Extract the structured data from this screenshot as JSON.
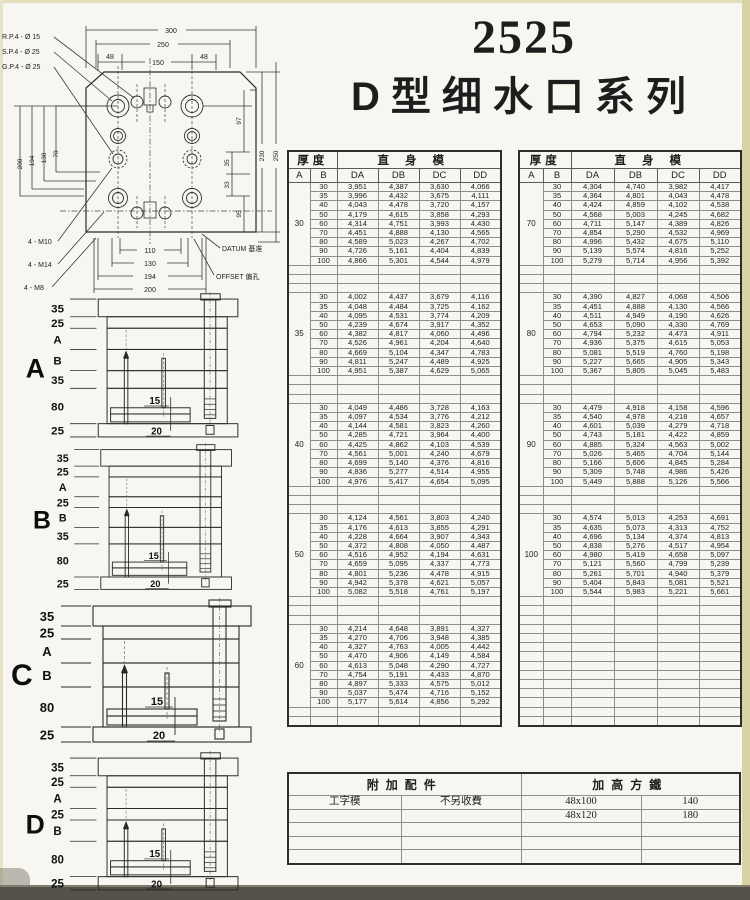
{
  "title": {
    "number": "2525",
    "series": "D型细水口系列"
  },
  "drawing": {
    "hole_labels": [
      "R.P.4 - Ø 15",
      "S.P.4 - Ø 25",
      "G.P.4 - Ø 25"
    ],
    "thread_labels": [
      "4 - M10",
      "4 - M14",
      "4 - M8"
    ],
    "datum_label": "DATUM 基准",
    "offset_label": "OFFSET 偏孔",
    "dim_300": "300",
    "dim_250": "250",
    "dim_48a": "48",
    "dim_150": "150",
    "dim_48b": "48",
    "left_dims": [
      "200",
      "194",
      "130",
      "70"
    ],
    "right_dims": [
      "97",
      "35",
      "33",
      "95",
      "230",
      "250"
    ],
    "bottom_dims": [
      "110",
      "130",
      "194",
      "200"
    ]
  },
  "diagrams": [
    {
      "label": "A",
      "stack": [
        "35",
        "25",
        "A",
        "B",
        "35",
        "80",
        "25"
      ],
      "inner_top": "15",
      "inner_bottom": "20"
    },
    {
      "label": "B",
      "stack": [
        "35",
        "25",
        "A",
        "25",
        "B",
        "35",
        "80",
        "25"
      ],
      "inner_top": "15",
      "inner_bottom": "20"
    },
    {
      "label": "C",
      "stack": [
        "35",
        "25",
        "A",
        "B",
        "80",
        "25"
      ],
      "inner_top": "15",
      "inner_bottom": "20"
    },
    {
      "label": "D",
      "stack": [
        "35",
        "25",
        "A",
        "25",
        "B",
        "80",
        "25"
      ],
      "inner_top": "15",
      "inner_bottom": "20"
    }
  ],
  "size_table": {
    "headers": {
      "thickness": "厚度",
      "mold": "直身模",
      "col_a": "A",
      "col_b": "B",
      "col_da": "DA",
      "col_db": "DB",
      "col_dc": "DC",
      "col_dd": "DD"
    },
    "left_blocks": [
      {
        "a": "30",
        "rows": [
          [
            "30",
            "3,951",
            "4,387",
            "3,630",
            "4,066"
          ],
          [
            "35",
            "3,996",
            "4,432",
            "3,675",
            "4,111"
          ],
          [
            "40",
            "4,043",
            "4,478",
            "3,720",
            "4,157"
          ],
          [
            "50",
            "4,179",
            "4,615",
            "3,858",
            "4,293"
          ],
          [
            "60",
            "4,314",
            "4,751",
            "3,993",
            "4,430"
          ],
          [
            "70",
            "4,451",
            "4,888",
            "4,130",
            "4,565"
          ],
          [
            "80",
            "4,589",
            "5,023",
            "4,267",
            "4,702"
          ],
          [
            "90",
            "4,726",
            "5,161",
            "4,404",
            "4,839"
          ],
          [
            "100",
            "4,866",
            "5,301",
            "4,544",
            "4,979"
          ]
        ]
      },
      {
        "a": "35",
        "rows": [
          [
            "30",
            "4,002",
            "4,437",
            "3,679",
            "4,116"
          ],
          [
            "35",
            "4,048",
            "4,484",
            "3,725",
            "4,162"
          ],
          [
            "40",
            "4,095",
            "4,531",
            "3,774",
            "4,209"
          ],
          [
            "50",
            "4,239",
            "4,674",
            "3,917",
            "4,352"
          ],
          [
            "60",
            "4,382",
            "4,817",
            "4,060",
            "4,496"
          ],
          [
            "70",
            "4,526",
            "4,961",
            "4,204",
            "4,640"
          ],
          [
            "80",
            "4,669",
            "5,104",
            "4,347",
            "4,783"
          ],
          [
            "90",
            "4,811",
            "5,247",
            "4,489",
            "4,925"
          ],
          [
            "100",
            "4,951",
            "5,387",
            "4,629",
            "5,065"
          ]
        ]
      },
      {
        "a": "40",
        "rows": [
          [
            "30",
            "4,049",
            "4,486",
            "3,728",
            "4,163"
          ],
          [
            "35",
            "4,097",
            "4,534",
            "3,776",
            "4,212"
          ],
          [
            "40",
            "4,144",
            "4,581",
            "3,823",
            "4,260"
          ],
          [
            "50",
            "4,285",
            "4,721",
            "3,964",
            "4,400"
          ],
          [
            "60",
            "4,425",
            "4,862",
            "4,103",
            "4,539"
          ],
          [
            "70",
            "4,561",
            "5,001",
            "4,240",
            "4,679"
          ],
          [
            "80",
            "4,699",
            "5,140",
            "4,376",
            "4,816"
          ],
          [
            "90",
            "4,836",
            "5,277",
            "4,514",
            "4,955"
          ],
          [
            "100",
            "4,976",
            "5,417",
            "4,654",
            "5,095"
          ]
        ]
      },
      {
        "a": "50",
        "rows": [
          [
            "30",
            "4,124",
            "4,561",
            "3,803",
            "4,240"
          ],
          [
            "35",
            "4,176",
            "4,613",
            "3,855",
            "4,291"
          ],
          [
            "40",
            "4,228",
            "4,664",
            "3,907",
            "4,343"
          ],
          [
            "50",
            "4,372",
            "4,808",
            "4,050",
            "4,487"
          ],
          [
            "60",
            "4,516",
            "4,952",
            "4,194",
            "4,631"
          ],
          [
            "70",
            "4,659",
            "5,095",
            "4,337",
            "4,773"
          ],
          [
            "80",
            "4,801",
            "5,236",
            "4,478",
            "4,915"
          ],
          [
            "90",
            "4,942",
            "5,378",
            "4,621",
            "5,057"
          ],
          [
            "100",
            "5,082",
            "5,518",
            "4,761",
            "5,197"
          ]
        ]
      },
      {
        "a": "60",
        "rows": [
          [
            "30",
            "4,214",
            "4,648",
            "3,891",
            "4,327"
          ],
          [
            "35",
            "4,270",
            "4,706",
            "3,948",
            "4,385"
          ],
          [
            "40",
            "4,327",
            "4,763",
            "4,005",
            "4,442"
          ],
          [
            "50",
            "4,470",
            "4,906",
            "4,149",
            "4,584"
          ],
          [
            "60",
            "4,613",
            "5,048",
            "4,290",
            "4,727"
          ],
          [
            "70",
            "4,754",
            "5,191",
            "4,433",
            "4,870"
          ],
          [
            "80",
            "4,897",
            "5,333",
            "4,575",
            "5,012"
          ],
          [
            "90",
            "5,037",
            "5,474",
            "4,716",
            "5,152"
          ],
          [
            "100",
            "5,177",
            "5,614",
            "4,856",
            "5,292"
          ]
        ]
      }
    ],
    "right_blocks": [
      {
        "a": "70",
        "rows": [
          [
            "30",
            "4,304",
            "4,740",
            "3,982",
            "4,417"
          ],
          [
            "35",
            "4,364",
            "4,801",
            "4,043",
            "4,478"
          ],
          [
            "40",
            "4,424",
            "4,859",
            "4,102",
            "4,538"
          ],
          [
            "50",
            "4,568",
            "5,003",
            "4,245",
            "4,682"
          ],
          [
            "60",
            "4,711",
            "5,147",
            "4,389",
            "4,826"
          ],
          [
            "70",
            "4,854",
            "5,290",
            "4,532",
            "4,969"
          ],
          [
            "80",
            "4,996",
            "5,432",
            "4,675",
            "5,110"
          ],
          [
            "90",
            "5,139",
            "5,574",
            "4,816",
            "5,252"
          ],
          [
            "100",
            "5,279",
            "5,714",
            "4,956",
            "5,392"
          ]
        ]
      },
      {
        "a": "80",
        "rows": [
          [
            "30",
            "4,390",
            "4,827",
            "4,068",
            "4,506"
          ],
          [
            "35",
            "4,451",
            "4,888",
            "4,130",
            "4,566"
          ],
          [
            "40",
            "4,511",
            "4,949",
            "4,190",
            "4,626"
          ],
          [
            "50",
            "4,653",
            "5,090",
            "4,330",
            "4,769"
          ],
          [
            "60",
            "4,794",
            "5,232",
            "4,473",
            "4,911"
          ],
          [
            "70",
            "4,936",
            "5,375",
            "4,615",
            "5,053"
          ],
          [
            "80",
            "5,081",
            "5,519",
            "4,760",
            "5,198"
          ],
          [
            "90",
            "5,227",
            "5,665",
            "4,905",
            "5,343"
          ],
          [
            "100",
            "5,367",
            "5,805",
            "5,045",
            "5,483"
          ]
        ]
      },
      {
        "a": "90",
        "rows": [
          [
            "30",
            "4,479",
            "4,918",
            "4,158",
            "4,596"
          ],
          [
            "35",
            "4,540",
            "4,978",
            "4,218",
            "4,657"
          ],
          [
            "40",
            "4,601",
            "5,039",
            "4,279",
            "4,718"
          ],
          [
            "50",
            "4,743",
            "5,181",
            "4,422",
            "4,859"
          ],
          [
            "60",
            "4,885",
            "5,324",
            "4,563",
            "5,002"
          ],
          [
            "70",
            "5,026",
            "5,465",
            "4,704",
            "5,144"
          ],
          [
            "80",
            "5,166",
            "5,606",
            "4,845",
            "5,284"
          ],
          [
            "90",
            "5,309",
            "5,748",
            "4,986",
            "5,426"
          ],
          [
            "100",
            "5,449",
            "5,888",
            "5,126",
            "5,566"
          ]
        ]
      },
      {
        "a": "100",
        "rows": [
          [
            "30",
            "4,574",
            "5,013",
            "4,253",
            "4,691"
          ],
          [
            "35",
            "4,635",
            "5,073",
            "4,313",
            "4,752"
          ],
          [
            "40",
            "4,696",
            "5,134",
            "4,374",
            "4,813"
          ],
          [
            "50",
            "4,838",
            "5,276",
            "4,517",
            "4,954"
          ],
          [
            "60",
            "4,980",
            "5,419",
            "4,658",
            "5,097"
          ],
          [
            "70",
            "5,121",
            "5,560",
            "4,799",
            "5,239"
          ],
          [
            "80",
            "5,261",
            "5,701",
            "4,940",
            "5,379"
          ],
          [
            "90",
            "5,404",
            "5,843",
            "5,081",
            "5,521"
          ],
          [
            "100",
            "5,544",
            "5,983",
            "5,221",
            "5,661"
          ]
        ]
      }
    ]
  },
  "accessories": {
    "header_left": "附加配件",
    "header_right": "加高方鐵",
    "rows": [
      [
        "工字模",
        "不另收費",
        "48x100",
        "140"
      ],
      [
        "",
        "",
        "48x120",
        "180"
      ],
      [
        "",
        "",
        "",
        ""
      ],
      [
        "",
        "",
        "",
        ""
      ],
      [
        "",
        "",
        "",
        ""
      ]
    ]
  }
}
